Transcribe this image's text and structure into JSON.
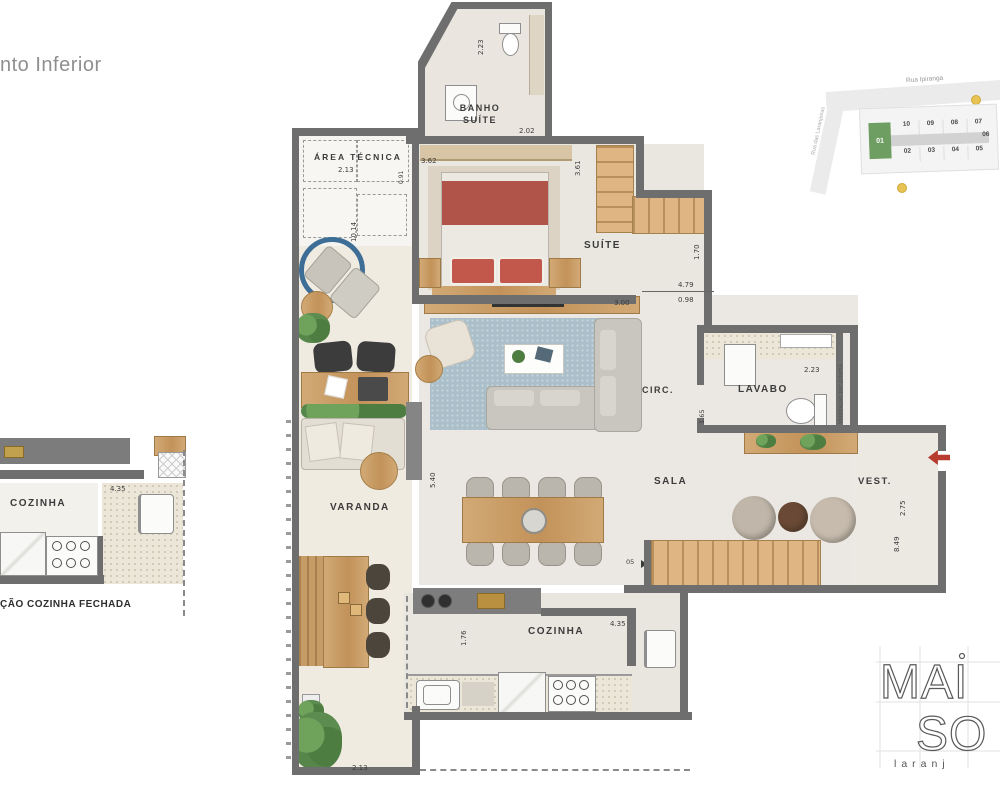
{
  "title": "nto Inferior",
  "plan": {
    "labels": {
      "banho_line1": "BANHO",
      "banho_line2": "SUÍTE",
      "area_tecnica": "ÁREA TÉCNICA",
      "suite": "SUÍTE",
      "circ": "CIRC.",
      "lavabo": "LAVABO",
      "sala": "SALA",
      "vest": "VEST.",
      "varanda": "VARANDA",
      "cozinha": "COZINHA"
    },
    "dims": {
      "banho_width": "2.23",
      "banho_door": "2.02",
      "area_tecnica_width": "2.13",
      "left_wing_height": "10.14",
      "area_tecnica_right": "0.91",
      "suite_width": "3.62",
      "suite_top": "3.61",
      "stair_shaft": "1.70",
      "circ_length": "4.79",
      "circ_offset": "0.98",
      "sideboard": "3.00",
      "lavabo_width": "2.23",
      "lavabo_height": "1.65",
      "varanda_height": "5.40",
      "vest_height": "2.75",
      "right_side_height": "8.49",
      "cozinha_door": "1.76",
      "cozinha_width": "4.35",
      "varanda_bottom": "2.13"
    },
    "notes": {
      "ventilation": "Ventilação por prisma",
      "stair_number": "05"
    }
  },
  "inset": {
    "label_cozinha": "COZINHA",
    "dim_width": "4.35",
    "caption": "ÇÃO COZINHA FECHADA"
  },
  "site_map": {
    "street_top": "Rua Ipiranga",
    "street_left": "Rua das Laranjeiras",
    "unit_highlight": "01",
    "units_top": [
      "10",
      "09",
      "08",
      "07"
    ],
    "units_bottom": [
      "02",
      "03",
      "04",
      "05"
    ],
    "unit_right": "06"
  },
  "logo": {
    "line1": "MAI",
    "line2": "SO",
    "subtitle": "laranj"
  },
  "colors": {
    "wall": "#6e6e6e",
    "wood": "#c9a36d",
    "bed": "#b0544a",
    "rug": "#aabfca",
    "highlight_green": "#6f9e63",
    "accent_red": "#b73b2f"
  }
}
